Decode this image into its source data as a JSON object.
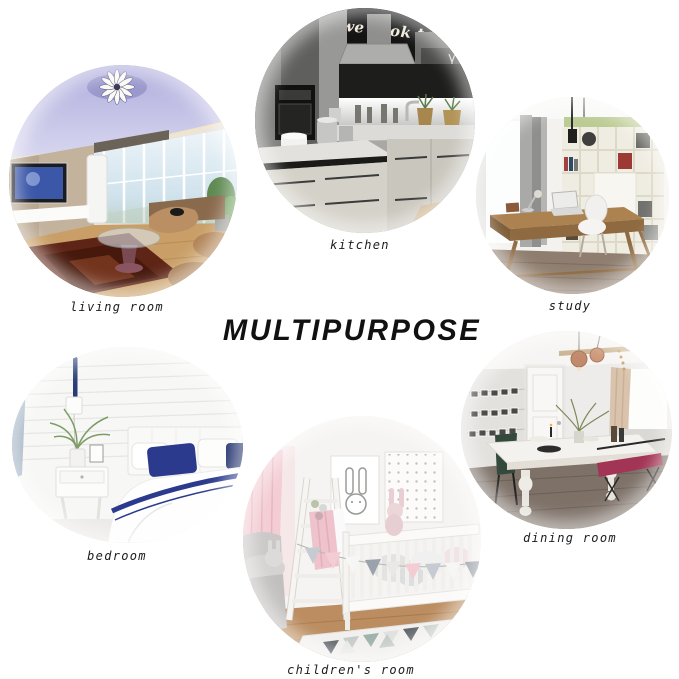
{
  "title": {
    "text": "MULTIPURPOSE"
  },
  "rooms": [
    {
      "id": "living-room",
      "label": "living room"
    },
    {
      "id": "kitchen",
      "label": "kitchen",
      "wall_text": "we cook tog"
    },
    {
      "id": "study",
      "label": "study"
    },
    {
      "id": "bedroom",
      "label": "bedroom"
    },
    {
      "id": "children-room",
      "label": "children's room"
    },
    {
      "id": "dining-room",
      "label": "dining room"
    }
  ],
  "colors": {
    "background": "#ffffff",
    "title_text": "#111111",
    "label_text": "#1c1c1c",
    "living_room_ceiling_lavender": "#b7b5e0",
    "kitchen_wall_black": "#141414",
    "study_shelf_green": "#bccb93",
    "bedroom_pillow_navy": "#2b3a8c",
    "children_curtain_pink": "#f3cdd3",
    "dining_bench_magenta": "#a23455"
  }
}
